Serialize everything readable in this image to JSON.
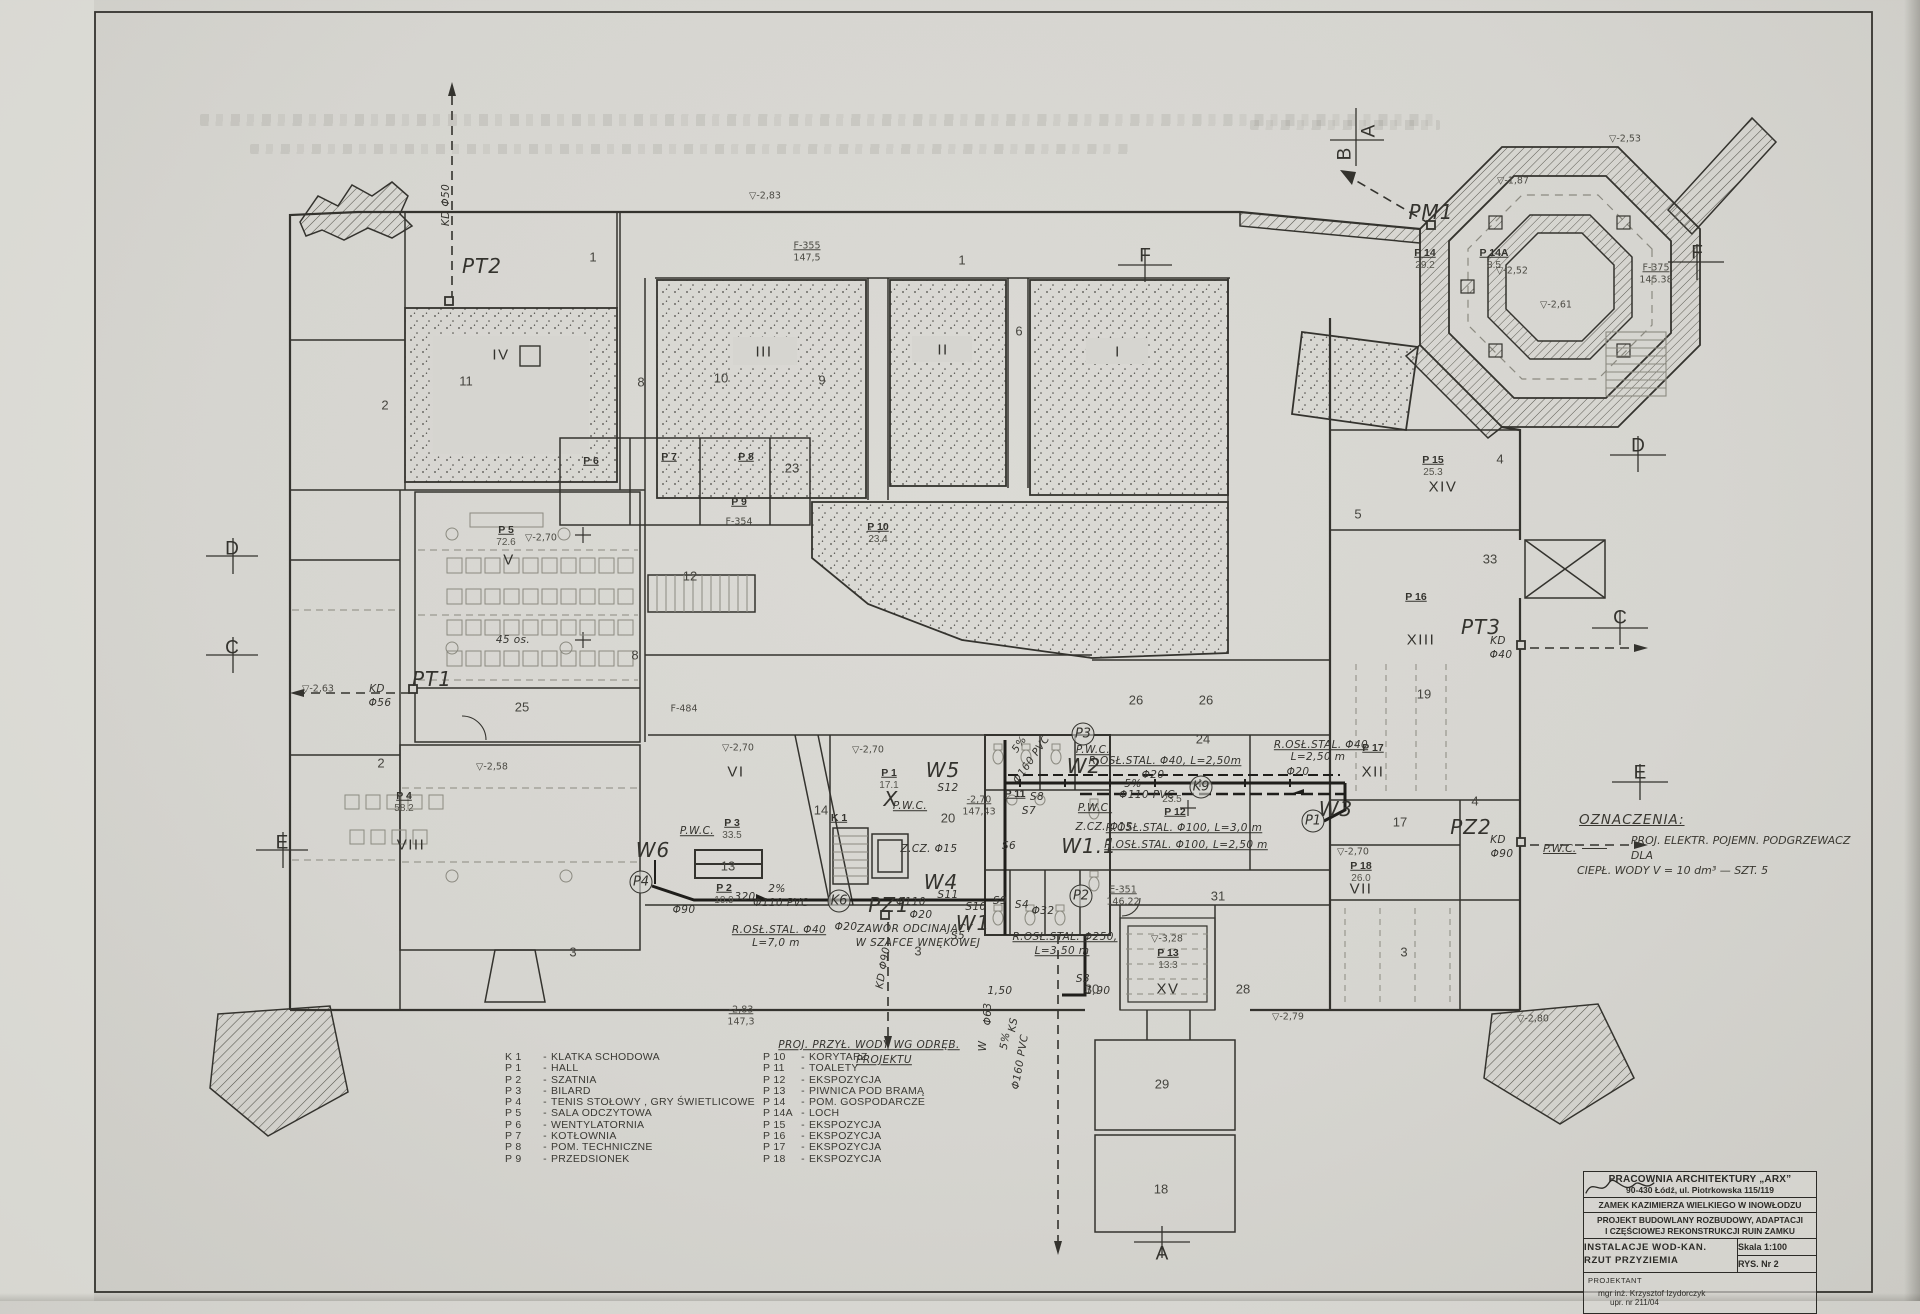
{
  "colors": {
    "paper": "#d6d5d0",
    "ink": "#34332e",
    "pencil": "#8b8a80",
    "pipe": "#1f1e1b"
  },
  "title_block": {
    "studio_name": "PRACOWNIA ARCHITEKTURY „ARX”",
    "studio_address": "90-430 Łódź, ul. Piotrkowska 115/119",
    "project_object": "ZAMEK KAZIMIERZA WIELKIEGO W INOWŁODZU",
    "project_scope_line1": "PROJEKT BUDOWLANY ROZBUDOWY, ADAPTACJI",
    "project_scope_line2": "I CZĘŚCIOWEJ REKONSTRUKCJI RUIN ZAMKU",
    "drawing_title_line1": "INSTALACJE WOD-KAN.",
    "drawing_title_line2": "RZUT PRZYZIEMIA",
    "scale_label": "Skala 1:100",
    "sheet_number": "RYS. Nr 2",
    "designer_role": "PROJEKTANT",
    "designer_name": "mgr inż. Krzysztof Izydorczyk",
    "designer_license": "upr. nr 211/04"
  },
  "legend": {
    "separator": "-",
    "column1": [
      {
        "code": "K 1",
        "label": "KLATKA SCHODOWA"
      },
      {
        "code": "P 1",
        "label": "HALL"
      },
      {
        "code": "P 2",
        "label": "SZATNIA"
      },
      {
        "code": "P 3",
        "label": "BILARD"
      },
      {
        "code": "P 4",
        "label": "TENIS STOŁOWY , GRY ŚWIETLICOWE"
      },
      {
        "code": "P 5",
        "label": "SALA ODCZYTOWA"
      },
      {
        "code": "P 6",
        "label": "WENTYLATORNIA"
      },
      {
        "code": "P 7",
        "label": "KOTŁOWNIA"
      },
      {
        "code": "P 8",
        "label": "POM. TECHNICZNE"
      },
      {
        "code": "P 9",
        "label": "PRZEDSIONEK"
      }
    ],
    "column2": [
      {
        "code": "P 10",
        "label": "KORYTARZ"
      },
      {
        "code": "P 11",
        "label": "TOALETY"
      },
      {
        "code": "P 12",
        "label": "EKSPOZYCJA"
      },
      {
        "code": "P 13",
        "label": "PIWNICA POD BRAMĄ"
      },
      {
        "code": "P 14",
        "label": "POM. GOSPODARCZE"
      },
      {
        "code": "P 14A",
        "label": "LOCH"
      },
      {
        "code": "P 15",
        "label": "EKSPOZYCJA"
      },
      {
        "code": "P 16",
        "label": "EKSPOZYCJA"
      },
      {
        "code": "P 17",
        "label": "EKSPOZYCJA"
      },
      {
        "code": "P 18",
        "label": "EKSPOZYCJA"
      }
    ]
  },
  "oznaczenia": {
    "heading": "OZNACZENIA:",
    "symbol": "P.W.C.",
    "line1": "PROJ. ELEKTR. POJEMN. PODGRZEWACZ DLA",
    "line2": "CIEPŁ. WODY  V = 10 dm³ — SZT. 5"
  },
  "plan_labels": [
    {
      "t": "D",
      "x": 232,
      "y": 549,
      "c": "sec"
    },
    {
      "t": "C",
      "x": 232,
      "y": 648,
      "c": "sec"
    },
    {
      "t": "E",
      "x": 282,
      "y": 843,
      "c": "sec"
    },
    {
      "t": "F",
      "x": 1145,
      "y": 256,
      "c": "sec"
    },
    {
      "t": "F",
      "x": 1697,
      "y": 253,
      "c": "sec"
    },
    {
      "t": "D",
      "x": 1638,
      "y": 446,
      "c": "sec"
    },
    {
      "t": "C",
      "x": 1620,
      "y": 618,
      "c": "sec"
    },
    {
      "t": "E",
      "x": 1640,
      "y": 773,
      "c": "sec"
    },
    {
      "t": "A",
      "x": 1162,
      "y": 1254,
      "c": "sec"
    },
    {
      "t": "A",
      "x": 1369,
      "y": 131,
      "c": "sec",
      "r": -90
    },
    {
      "t": "B",
      "x": 1345,
      "y": 154,
      "c": "sec",
      "r": -90
    },
    {
      "t": "PT2",
      "x": 482,
      "y": 266,
      "c": "big"
    },
    {
      "t": "PT1",
      "x": 432,
      "y": 679,
      "c": "big"
    },
    {
      "t": "PT3",
      "x": 1481,
      "y": 627,
      "c": "big"
    },
    {
      "t": "PZ2",
      "x": 1471,
      "y": 827,
      "c": "big"
    },
    {
      "t": "PZ1",
      "x": 889,
      "y": 905,
      "c": "big"
    },
    {
      "t": "PM1",
      "x": 1431,
      "y": 212,
      "c": "big"
    },
    {
      "t": "W1",
      "x": 973,
      "y": 923,
      "c": "big"
    },
    {
      "t": "W1.1",
      "x": 1089,
      "y": 846,
      "c": "big"
    },
    {
      "t": "W2",
      "x": 1084,
      "y": 766,
      "c": "big"
    },
    {
      "t": "W3",
      "x": 1336,
      "y": 809,
      "c": "big"
    },
    {
      "t": "W4",
      "x": 941,
      "y": 882,
      "c": "big"
    },
    {
      "t": "W5",
      "x": 943,
      "y": 770,
      "c": "big"
    },
    {
      "t": "W6",
      "x": 653,
      "y": 850,
      "c": "big"
    },
    {
      "t": "X",
      "x": 891,
      "y": 799,
      "c": "big"
    },
    {
      "t": "P4",
      "x": 641,
      "y": 882,
      "c": "circ"
    },
    {
      "t": "P3",
      "x": 1083,
      "y": 734,
      "c": "circ"
    },
    {
      "t": "P2",
      "x": 1081,
      "y": 896,
      "c": "circ"
    },
    {
      "t": "P1",
      "x": 1313,
      "y": 821,
      "c": "circ"
    },
    {
      "t": "K9",
      "x": 1201,
      "y": 787,
      "c": "circ"
    },
    {
      "t": "K6",
      "x": 839,
      "y": 901,
      "c": "circ"
    },
    {
      "t": "KD Φ50",
      "x": 447,
      "y": 205,
      "c": "hand",
      "r": -90
    },
    {
      "t": "KD",
      "x": 377,
      "y": 690,
      "c": "hand"
    },
    {
      "t": "Φ56",
      "x": 380,
      "y": 704,
      "c": "hand"
    },
    {
      "t": "KD",
      "x": 1498,
      "y": 642,
      "c": "hand"
    },
    {
      "t": "Φ40",
      "x": 1501,
      "y": 656,
      "c": "hand"
    },
    {
      "t": "KD",
      "x": 1498,
      "y": 841,
      "c": "hand"
    },
    {
      "t": "Φ90",
      "x": 1502,
      "y": 855,
      "c": "hand"
    },
    {
      "t": "KD Φ90",
      "x": 884,
      "y": 968,
      "c": "hand",
      "r": -80
    },
    {
      "t": "R.OSŁ.STAL. Φ40, L=2,50m",
      "x": 1165,
      "y": 762,
      "c": "hand",
      "u": 1
    },
    {
      "t": "Φ20",
      "x": 1153,
      "y": 776,
      "c": "hand"
    },
    {
      "t": "5%",
      "x": 1133,
      "y": 785,
      "c": "hand"
    },
    {
      "t": "Φ110 PVC",
      "x": 1147,
      "y": 796,
      "c": "hand"
    },
    {
      "t": "R.OSŁ.STAL. Φ100, L=3,0 m",
      "x": 1184,
      "y": 829,
      "c": "hand",
      "u": 1
    },
    {
      "t": "R.OSŁ.STAL. Φ100, L=2,50 m",
      "x": 1186,
      "y": 846,
      "c": "hand",
      "u": 1
    },
    {
      "t": "Z.CZ. Φ15",
      "x": 1104,
      "y": 828,
      "c": "hand"
    },
    {
      "t": "Z.CZ. Φ15",
      "x": 929,
      "y": 850,
      "c": "hand"
    },
    {
      "t": "R.OSŁ.STAL. Φ40",
      "x": 1321,
      "y": 746,
      "c": "hand",
      "u": 1
    },
    {
      "t": "L=2,50 m",
      "x": 1318,
      "y": 758,
      "c": "hand"
    },
    {
      "t": "Φ20",
      "x": 1298,
      "y": 773,
      "c": "hand"
    },
    {
      "t": "R.OSŁ.STAL. Φ40",
      "x": 779,
      "y": 931,
      "c": "hand",
      "u": 1
    },
    {
      "t": "L=7,0 m",
      "x": 776,
      "y": 944,
      "c": "hand"
    },
    {
      "t": "R.OSŁ.STAL. Φ250,",
      "x": 1065,
      "y": 938,
      "c": "hand",
      "u": 1
    },
    {
      "t": "L=3,50 m",
      "x": 1062,
      "y": 952,
      "c": "hand",
      "u": 1
    },
    {
      "t": "ZAWÓR ODCINAJĄCY",
      "x": 915,
      "y": 930,
      "c": "hand"
    },
    {
      "t": "W SZAFCE WNĘKOWEJ",
      "x": 918,
      "y": 944,
      "c": "hand"
    },
    {
      "t": "PROJ. PRZYŁ. WODY WG ODRĘB.",
      "x": 869,
      "y": 1046,
      "c": "hand",
      "u": 1
    },
    {
      "t": "PROJEKTU",
      "x": 884,
      "y": 1061,
      "c": "hand",
      "u": 1
    },
    {
      "t": "2%",
      "x": 777,
      "y": 890,
      "c": "hand"
    },
    {
      "t": "Φ110 PVC",
      "x": 781,
      "y": 904,
      "c": "hand"
    },
    {
      "t": "320",
      "x": 745,
      "y": 898,
      "c": "hand"
    },
    {
      "t": "Φ160 PVC",
      "x": 1032,
      "y": 760,
      "c": "hand",
      "r": -55
    },
    {
      "t": "5%",
      "x": 1020,
      "y": 745,
      "c": "hand",
      "r": -55
    },
    {
      "t": "Φ110",
      "x": 911,
      "y": 903,
      "c": "hand"
    },
    {
      "t": "Φ20",
      "x": 921,
      "y": 916,
      "c": "hand"
    },
    {
      "t": "Φ20",
      "x": 846,
      "y": 928,
      "c": "hand"
    },
    {
      "t": "Φ90",
      "x": 684,
      "y": 911,
      "c": "hand"
    },
    {
      "t": "1,50",
      "x": 1000,
      "y": 992,
      "c": "hand"
    },
    {
      "t": "S3",
      "x": 1083,
      "y": 980,
      "c": "hand"
    },
    {
      "t": "1,90",
      "x": 1098,
      "y": 992,
      "c": "hand"
    },
    {
      "t": "Φ63",
      "x": 989,
      "y": 1014,
      "c": "hand",
      "r": -90
    },
    {
      "t": "W",
      "x": 984,
      "y": 1046,
      "c": "hand",
      "r": -90
    },
    {
      "t": "KS",
      "x": 1014,
      "y": 1025,
      "c": "hand",
      "r": -80
    },
    {
      "t": "5%",
      "x": 1006,
      "y": 1041,
      "c": "hand",
      "r": -80
    },
    {
      "t": "Φ160 PVC",
      "x": 1021,
      "y": 1062,
      "c": "hand",
      "r": -80
    },
    {
      "t": "P.W.C.",
      "x": 1093,
      "y": 751,
      "c": "hand",
      "u": 1
    },
    {
      "t": "P.W.C.",
      "x": 1095,
      "y": 809,
      "c": "hand",
      "u": 1
    },
    {
      "t": "P.W.C.",
      "x": 910,
      "y": 807,
      "c": "hand",
      "u": 1
    },
    {
      "t": "P.W.C.",
      "x": 697,
      "y": 832,
      "c": "hand",
      "u": 1
    },
    {
      "t": "S12",
      "x": 948,
      "y": 789,
      "c": "hand"
    },
    {
      "t": "S11",
      "x": 948,
      "y": 896,
      "c": "hand"
    },
    {
      "t": "S10",
      "x": 976,
      "y": 908,
      "c": "hand"
    },
    {
      "t": "S9",
      "x": 1000,
      "y": 902,
      "c": "hand"
    },
    {
      "t": "S8",
      "x": 1037,
      "y": 798,
      "c": "hand"
    },
    {
      "t": "S7",
      "x": 1029,
      "y": 812,
      "c": "hand"
    },
    {
      "t": "S6",
      "x": 1009,
      "y": 847,
      "c": "hand"
    },
    {
      "t": "S5",
      "x": 958,
      "y": 937,
      "c": "hand"
    },
    {
      "t": "S4",
      "x": 1022,
      "y": 906,
      "c": "hand"
    },
    {
      "t": "Φ32",
      "x": 1043,
      "y": 912,
      "c": "hand"
    },
    {
      "t": "45 os.",
      "x": 513,
      "y": 641,
      "c": "hand"
    },
    {
      "t": "1",
      "x": 593,
      "y": 257,
      "c": "num"
    },
    {
      "t": "1",
      "x": 962,
      "y": 260,
      "c": "num"
    },
    {
      "t": "2",
      "x": 385,
      "y": 405,
      "c": "num"
    },
    {
      "t": "2",
      "x": 381,
      "y": 763,
      "c": "num"
    },
    {
      "t": "3",
      "x": 573,
      "y": 952,
      "c": "num"
    },
    {
      "t": "3",
      "x": 918,
      "y": 951,
      "c": "num"
    },
    {
      "t": "3",
      "x": 1404,
      "y": 952,
      "c": "num"
    },
    {
      "t": "4",
      "x": 1475,
      "y": 801,
      "c": "num"
    },
    {
      "t": "4",
      "x": 1500,
      "y": 459,
      "c": "num"
    },
    {
      "t": "5",
      "x": 1358,
      "y": 514,
      "c": "num"
    },
    {
      "t": "6",
      "x": 1019,
      "y": 331,
      "c": "num"
    },
    {
      "t": "8",
      "x": 641,
      "y": 382,
      "c": "num"
    },
    {
      "t": "8",
      "x": 635,
      "y": 655,
      "c": "num"
    },
    {
      "t": "9",
      "x": 822,
      "y": 380,
      "c": "num"
    },
    {
      "t": "10",
      "x": 721,
      "y": 378,
      "c": "num"
    },
    {
      "t": "11",
      "x": 466,
      "y": 381,
      "c": "num"
    },
    {
      "t": "12",
      "x": 690,
      "y": 576,
      "c": "num"
    },
    {
      "t": "13",
      "x": 728,
      "y": 866,
      "c": "num"
    },
    {
      "t": "14",
      "x": 821,
      "y": 810,
      "c": "num"
    },
    {
      "t": "17",
      "x": 1400,
      "y": 822,
      "c": "num"
    },
    {
      "t": "18",
      "x": 1161,
      "y": 1189,
      "c": "num"
    },
    {
      "t": "19",
      "x": 1424,
      "y": 694,
      "c": "num"
    },
    {
      "t": "20",
      "x": 948,
      "y": 818,
      "c": "num"
    },
    {
      "t": "23",
      "x": 792,
      "y": 468,
      "c": "num"
    },
    {
      "t": "24",
      "x": 1203,
      "y": 739,
      "c": "num"
    },
    {
      "t": "25",
      "x": 522,
      "y": 707,
      "c": "num"
    },
    {
      "t": "26",
      "x": 1136,
      "y": 700,
      "c": "num"
    },
    {
      "t": "26",
      "x": 1206,
      "y": 700,
      "c": "num"
    },
    {
      "t": "28",
      "x": 1243,
      "y": 989,
      "c": "num"
    },
    {
      "t": "29",
      "x": 1162,
      "y": 1084,
      "c": "num"
    },
    {
      "t": "30",
      "x": 1092,
      "y": 989,
      "c": "num"
    },
    {
      "t": "31",
      "x": 1218,
      "y": 896,
      "c": "num"
    },
    {
      "t": "33",
      "x": 1490,
      "y": 559,
      "c": "num"
    },
    {
      "t": "IV",
      "x": 501,
      "y": 355,
      "c": "rom"
    },
    {
      "t": "III",
      "x": 764,
      "y": 352,
      "c": "rom"
    },
    {
      "t": "II",
      "x": 943,
      "y": 350,
      "c": "rom"
    },
    {
      "t": "I",
      "x": 1118,
      "y": 352,
      "c": "rom"
    },
    {
      "t": "V",
      "x": 509,
      "y": 560,
      "c": "rom"
    },
    {
      "t": "VI",
      "x": 736,
      "y": 772,
      "c": "rom"
    },
    {
      "t": "VII",
      "x": 1361,
      "y": 889,
      "c": "rom"
    },
    {
      "t": "VIII",
      "x": 411,
      "y": 845,
      "c": "rom"
    },
    {
      "t": "XII",
      "x": 1373,
      "y": 772,
      "c": "rom"
    },
    {
      "t": "XIII",
      "x": 1421,
      "y": 640,
      "c": "rom"
    },
    {
      "t": "XIV",
      "x": 1443,
      "y": 487,
      "c": "rom"
    },
    {
      "t": "XV",
      "x": 1168,
      "y": 989,
      "c": "rom"
    },
    {
      "t": "P 5",
      "x": 506,
      "y": 530,
      "c": "code"
    },
    {
      "t": "72.6",
      "x": 506,
      "y": 543,
      "c": "val"
    },
    {
      "t": "P 4",
      "x": 404,
      "y": 796,
      "c": "code"
    },
    {
      "t": "58.2",
      "x": 404,
      "y": 809,
      "c": "val"
    },
    {
      "t": "P 3",
      "x": 732,
      "y": 823,
      "c": "code"
    },
    {
      "t": "33.5",
      "x": 732,
      "y": 836,
      "c": "val"
    },
    {
      "t": "P 2",
      "x": 724,
      "y": 888,
      "c": "code"
    },
    {
      "t": "10.9",
      "x": 724,
      "y": 901,
      "c": "val"
    },
    {
      "t": "P 1",
      "x": 889,
      "y": 773,
      "c": "code"
    },
    {
      "t": "17.1",
      "x": 889,
      "y": 786,
      "c": "val"
    },
    {
      "t": "P 6",
      "x": 591,
      "y": 461,
      "c": "code"
    },
    {
      "t": "P 7",
      "x": 669,
      "y": 457,
      "c": "code"
    },
    {
      "t": "P 8",
      "x": 746,
      "y": 457,
      "c": "code"
    },
    {
      "t": "P 9",
      "x": 739,
      "y": 502,
      "c": "code"
    },
    {
      "t": "P 10",
      "x": 878,
      "y": 527,
      "c": "code"
    },
    {
      "t": "23.4",
      "x": 878,
      "y": 540,
      "c": "val"
    },
    {
      "t": "P 11",
      "x": 1015,
      "y": 794,
      "c": "code"
    },
    {
      "t": "P 12",
      "x": 1175,
      "y": 812,
      "c": "code"
    },
    {
      "t": "23.5",
      "x": 1172,
      "y": 800,
      "c": "val"
    },
    {
      "t": "P 13",
      "x": 1168,
      "y": 953,
      "c": "code"
    },
    {
      "t": "13.3",
      "x": 1168,
      "y": 966,
      "c": "val"
    },
    {
      "t": "P 14",
      "x": 1425,
      "y": 253,
      "c": "code"
    },
    {
      "t": "29.2",
      "x": 1425,
      "y": 266,
      "c": "val"
    },
    {
      "t": "P 14A",
      "x": 1494,
      "y": 253,
      "c": "code"
    },
    {
      "t": "8.5",
      "x": 1494,
      "y": 266,
      "c": "val"
    },
    {
      "t": "P 15",
      "x": 1433,
      "y": 460,
      "c": "code"
    },
    {
      "t": "25.3",
      "x": 1433,
      "y": 473,
      "c": "val"
    },
    {
      "t": "P 16",
      "x": 1416,
      "y": 597,
      "c": "code"
    },
    {
      "t": "P 17",
      "x": 1373,
      "y": 748,
      "c": "code"
    },
    {
      "t": "P 18",
      "x": 1361,
      "y": 866,
      "c": "code"
    },
    {
      "t": "26.0",
      "x": 1361,
      "y": 879,
      "c": "val"
    },
    {
      "t": "K 1",
      "x": 839,
      "y": 818,
      "c": "code"
    },
    {
      "t": "▽-2,70",
      "x": 541,
      "y": 538,
      "c": "lvl"
    },
    {
      "t": "▽-2,58",
      "x": 492,
      "y": 767,
      "c": "lvl"
    },
    {
      "t": "▽-2,63",
      "x": 318,
      "y": 689,
      "c": "lvl"
    },
    {
      "t": "▽-2,53",
      "x": 1625,
      "y": 139,
      "c": "lvl"
    },
    {
      "t": "▽-1,87",
      "x": 1513,
      "y": 181,
      "c": "lvl"
    },
    {
      "t": "▽-2,52",
      "x": 1512,
      "y": 271,
      "c": "lvl"
    },
    {
      "t": "▽-2,61",
      "x": 1556,
      "y": 305,
      "c": "lvl"
    },
    {
      "t": "▽-2,70",
      "x": 868,
      "y": 750,
      "c": "lvl"
    },
    {
      "t": "▽-2,70",
      "x": 738,
      "y": 748,
      "c": "lvl"
    },
    {
      "t": "▽-2,70",
      "x": 1353,
      "y": 852,
      "c": "lvl"
    },
    {
      "t": "▽-3,28",
      "x": 1167,
      "y": 939,
      "c": "lvl"
    },
    {
      "t": "▽-2,79",
      "x": 1288,
      "y": 1017,
      "c": "lvl"
    },
    {
      "t": "▽-2,80",
      "x": 1533,
      "y": 1019,
      "c": "lvl"
    },
    {
      "t": "▽-2,83",
      "x": 765,
      "y": 196,
      "c": "lvl"
    },
    {
      "t": "-2,83",
      "x": 741,
      "y": 1010,
      "c": "lvl",
      "u": 1
    },
    {
      "t": "147,3",
      "x": 741,
      "y": 1022,
      "c": "lvl"
    },
    {
      "t": "-2,70",
      "x": 979,
      "y": 800,
      "c": "lvl",
      "u": 1
    },
    {
      "t": "147,43",
      "x": 979,
      "y": 812,
      "c": "lvl"
    },
    {
      "t": "E-351",
      "x": 1123,
      "y": 890,
      "c": "lvl",
      "u": 1
    },
    {
      "t": "146.22",
      "x": 1123,
      "y": 902,
      "c": "lvl"
    },
    {
      "t": "F-375",
      "x": 1656,
      "y": 268,
      "c": "lvl",
      "u": 1
    },
    {
      "t": "145.38",
      "x": 1656,
      "y": 280,
      "c": "lvl"
    },
    {
      "t": "F-355",
      "x": 807,
      "y": 246,
      "c": "lvl",
      "u": 1
    },
    {
      "t": "147,5",
      "x": 807,
      "y": 258,
      "c": "lvl"
    },
    {
      "t": "F-354",
      "x": 739,
      "y": 522,
      "c": "lvl"
    },
    {
      "t": "F-484",
      "x": 684,
      "y": 709,
      "c": "lvl"
    }
  ]
}
